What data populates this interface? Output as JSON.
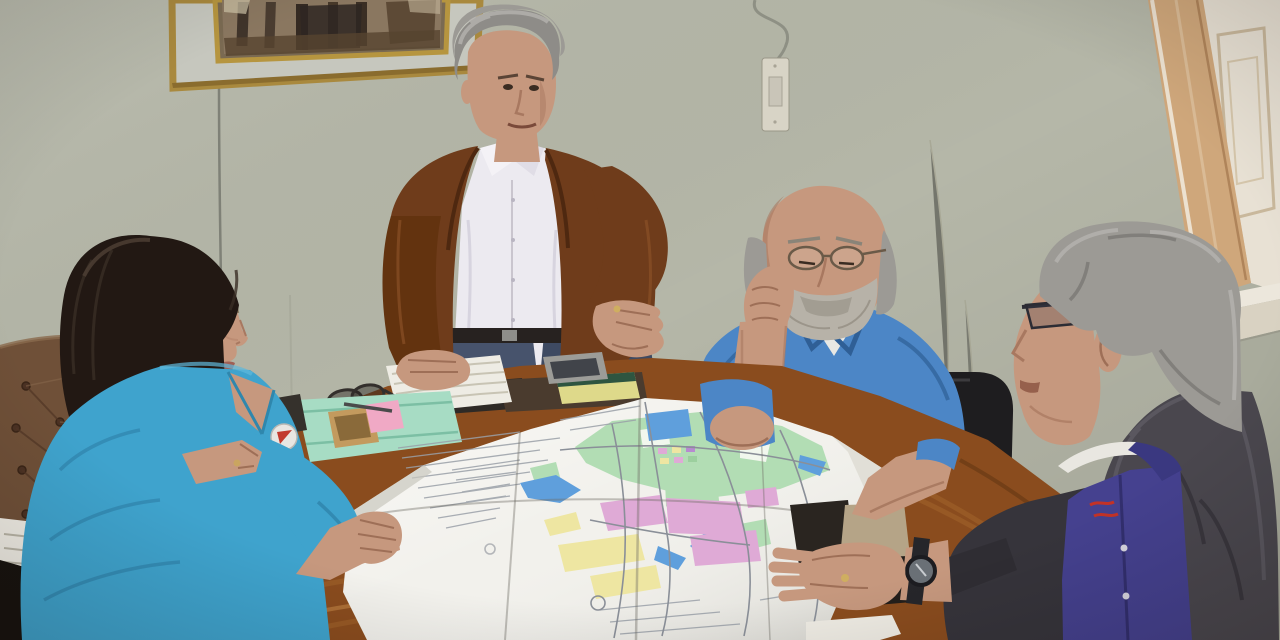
{
  "scene": {
    "type": "photograph",
    "description": "Four people meet in an office around a wooden table covered by a large folded city zoning map with green, pink, yellow and blue zones. A woman in a turquoise shirt sits at left in a brown tufted leather chair holding the map edge. A gray-haired man in a brown suede jacket and white shirt stands behind the table gesturing with an open palm. A bald man with a white beard, wire glasses and a blue polo rests his chin on his hand studying the map. A gray-haired man with dark glasses, a charcoal jacket and purple polo sits at right with his hand and wristwatch on the map. Behind them: a sage wall with a gold-framed painting, a light switch with hanging cable, and a tan wooden window at top right.",
    "setting": "municipal office meeting room",
    "people": [
      {
        "id": "woman-left",
        "appearance": "long dark hair, thin glasses, turquoise shirt, round white-and-red badge pin",
        "action": "seated, holding map corner"
      },
      {
        "id": "standing-man",
        "appearance": "gray hair, brown suede jacket, white shirt, jeans",
        "action": "standing, gesturing open palm over map"
      },
      {
        "id": "bearded-man",
        "appearance": "bald, gray side hair, wire glasses, white beard, blue polo with small flag logo",
        "action": "chin on hand, elbow on map"
      },
      {
        "id": "right-man",
        "appearance": "gray wavy hair, dark rectangular glasses, charcoal jacket over purple polo with red logo, wristwatch",
        "action": "seated, hand resting on map"
      }
    ],
    "objects": [
      "framed painting",
      "wall cable",
      "light switch",
      "wooden window with shutter",
      "tufted leather chair",
      "black office chair",
      "wooden table",
      "city zoning map",
      "mint folder",
      "pink sticky note",
      "gold phone",
      "silver phone",
      "white notebook",
      "dark binder",
      "yellow notepad",
      "folded eyeglasses",
      "wristwatch",
      "white receipt",
      "stacked papers"
    ]
  },
  "colors": {
    "wall": "#b5b7a8",
    "wall_lower": "#a9ab9c",
    "frame_gold": "#a9893e",
    "painting_mat": "#c6c7be",
    "painting_base": "#7a6a52",
    "window_frame_tan": "#cfa77b",
    "window_shutter": "#e8e1d4",
    "window_sill": "#ece7dc",
    "leather_chair": "#6f5038",
    "office_chair": "#1e1d1f",
    "table_wood": "#8a4c1e",
    "table_front": "#3d2410",
    "map_paper": "#f2f1ec",
    "zone_green": "#b2ddb4",
    "zone_blue": "#5f9fdc",
    "zone_pink": "#dfaad6",
    "zone_yellow": "#eee6a2",
    "woman_shirt": "#3fa3cd",
    "woman_hair": "#221813",
    "skin": "#c6987e",
    "standing_jacket": "#6f3c1b",
    "standing_shirt": "#eceaf0",
    "jeans": "#47536c",
    "bald_polo": "#4c86c6",
    "beard": "#b7b2a8",
    "gray_hair": "#9c9a95",
    "right_jacket": "#4a474e",
    "right_polo": "#45418f",
    "collar_white": "#e9e7e1",
    "logo_red": "#c33226",
    "folder_mint": "#a7dcc4",
    "sticky_pink": "#f0a9c5",
    "phone_gold": "#c39a5e",
    "phone_silver": "#9c9c98",
    "notebook_white": "#eeece4",
    "notepad_yellow": "#ded98a",
    "binder_dark": "#2e2a26",
    "khaki": "#b5a487",
    "watch_strap": "#26262a",
    "watch_face": "#6a7076",
    "paper_white": "#efece4",
    "badge_red": "#c23a2e"
  }
}
